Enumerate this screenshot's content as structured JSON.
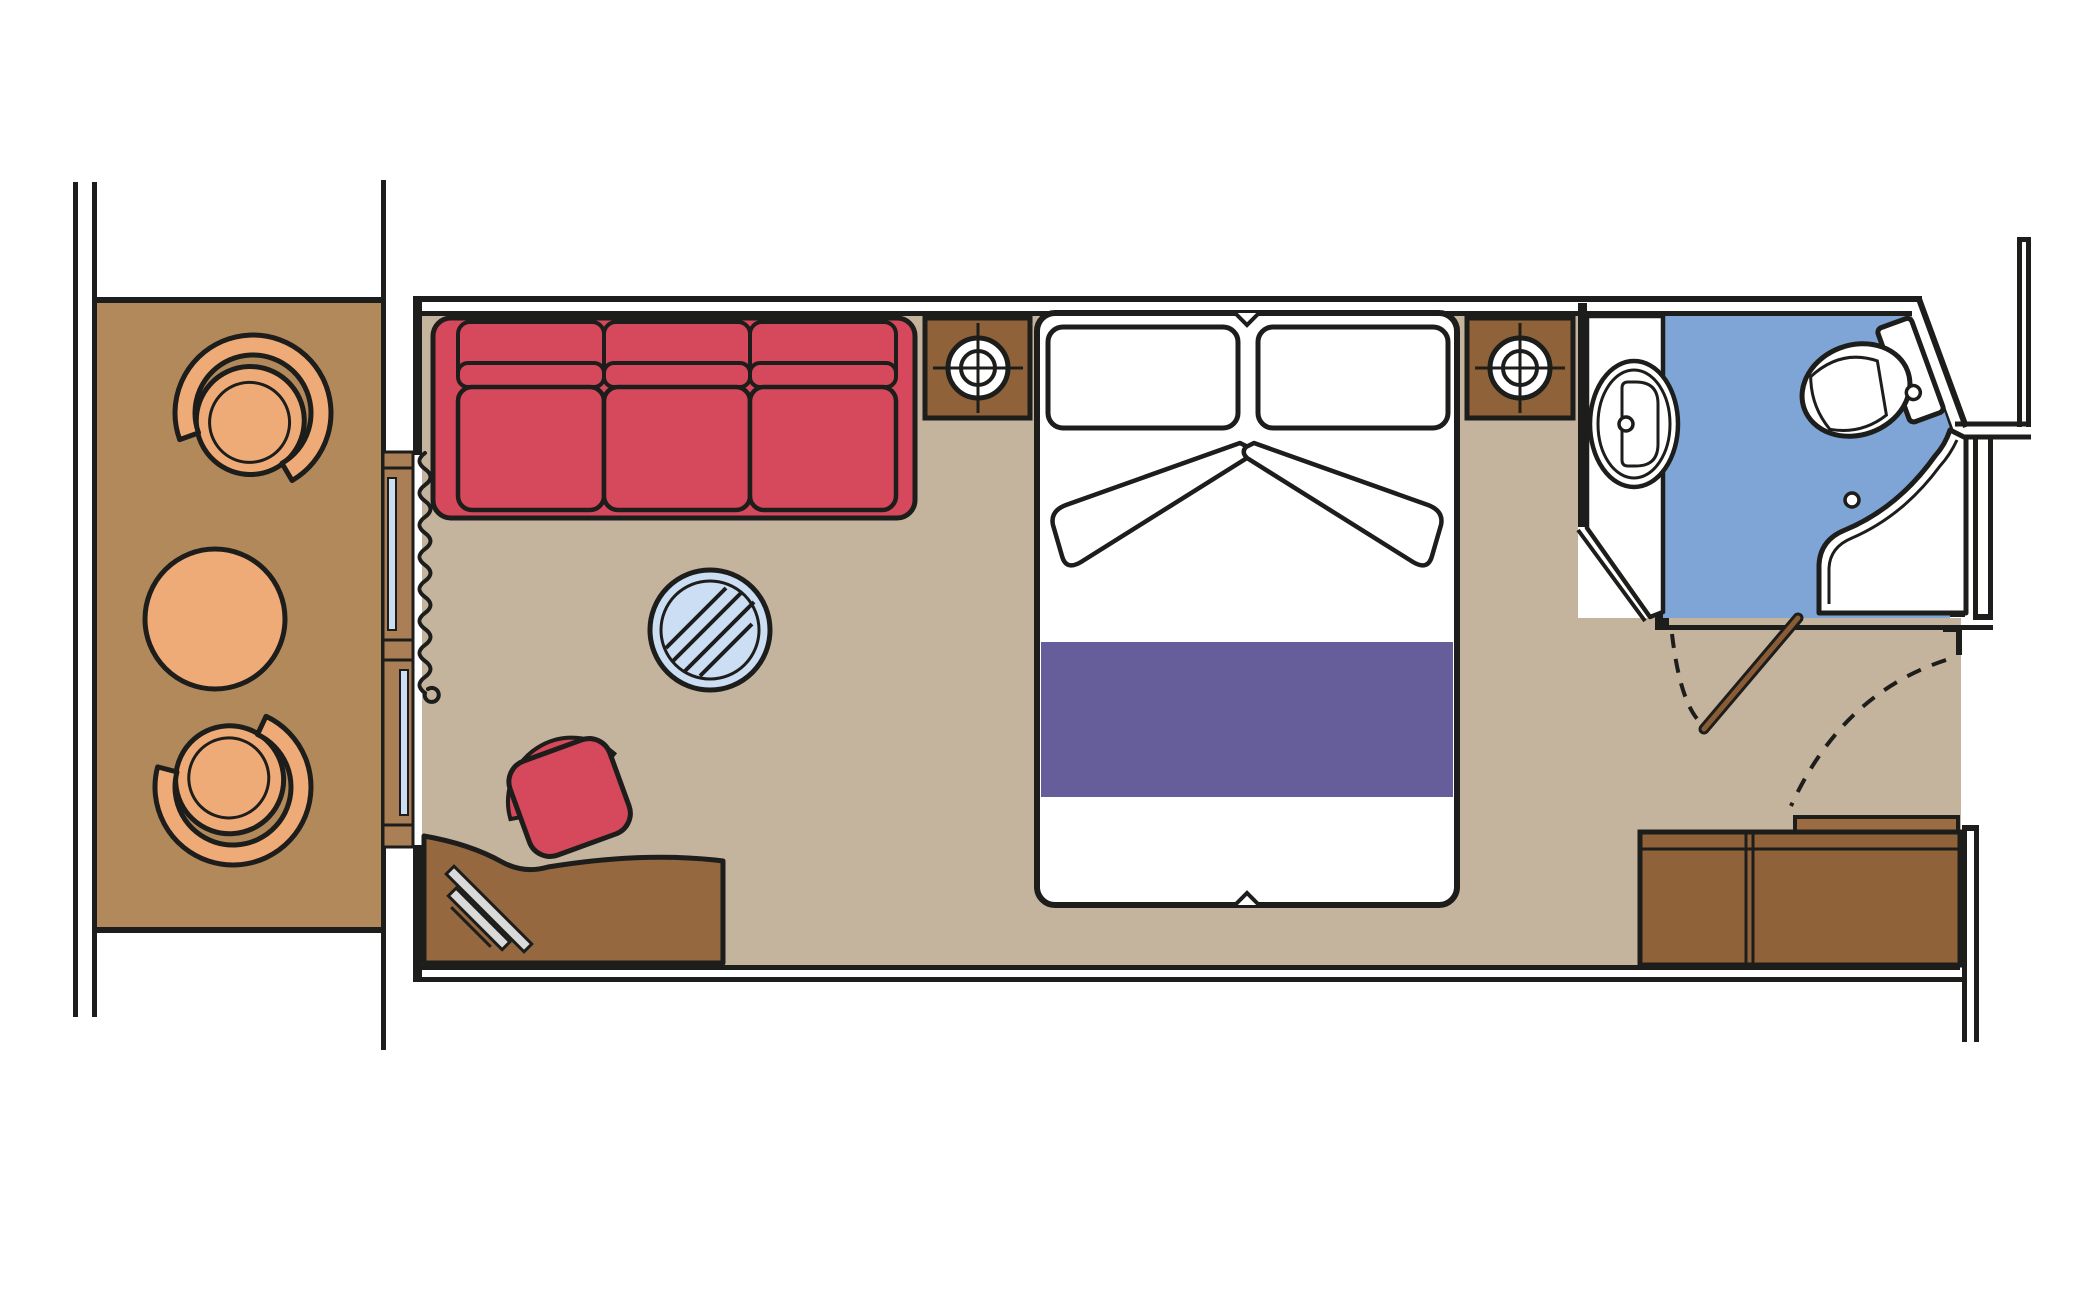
{
  "title": "Cabin floor plan",
  "colors": {
    "line": "#1d1d1b",
    "balcony_floor": "#b1895b",
    "cabin_floor": "#c4b49d",
    "bathroom_floor": "#7fa5d6",
    "glass_blue": "#cbdef3",
    "chair_peach": "#efab77",
    "sofa_red": "#d6495c",
    "bedspread_purple": "#655e9b",
    "wood_dark": "#8f6239",
    "wood_desk": "#95683f",
    "wood_door_frame": "#aa7f55",
    "wood_entry_leaf": "#8a5c36",
    "wood_shelf": "#9b6c42",
    "tv_gray": "#d9d9d9",
    "fixture_white": "#ffffff"
  },
  "areas": {
    "balcony": {
      "label": "Balcony",
      "furniture": [
        "armchair",
        "round table",
        "armchair"
      ]
    },
    "cabin": {
      "label": "Cabin",
      "furniture": [
        "sofa",
        "glass coffee table",
        "stool",
        "desk with tv",
        "double bed",
        "nightstand with lamp",
        "nightstand with lamp",
        "wardrobe cabinets",
        "shelf"
      ]
    },
    "bathroom": {
      "label": "Bathroom",
      "furniture": [
        "sink",
        "toilet",
        "shower"
      ]
    }
  },
  "icons": [
    "lamp-icon",
    "curtain-icon",
    "tv-icon",
    "door-swing-icon"
  ]
}
